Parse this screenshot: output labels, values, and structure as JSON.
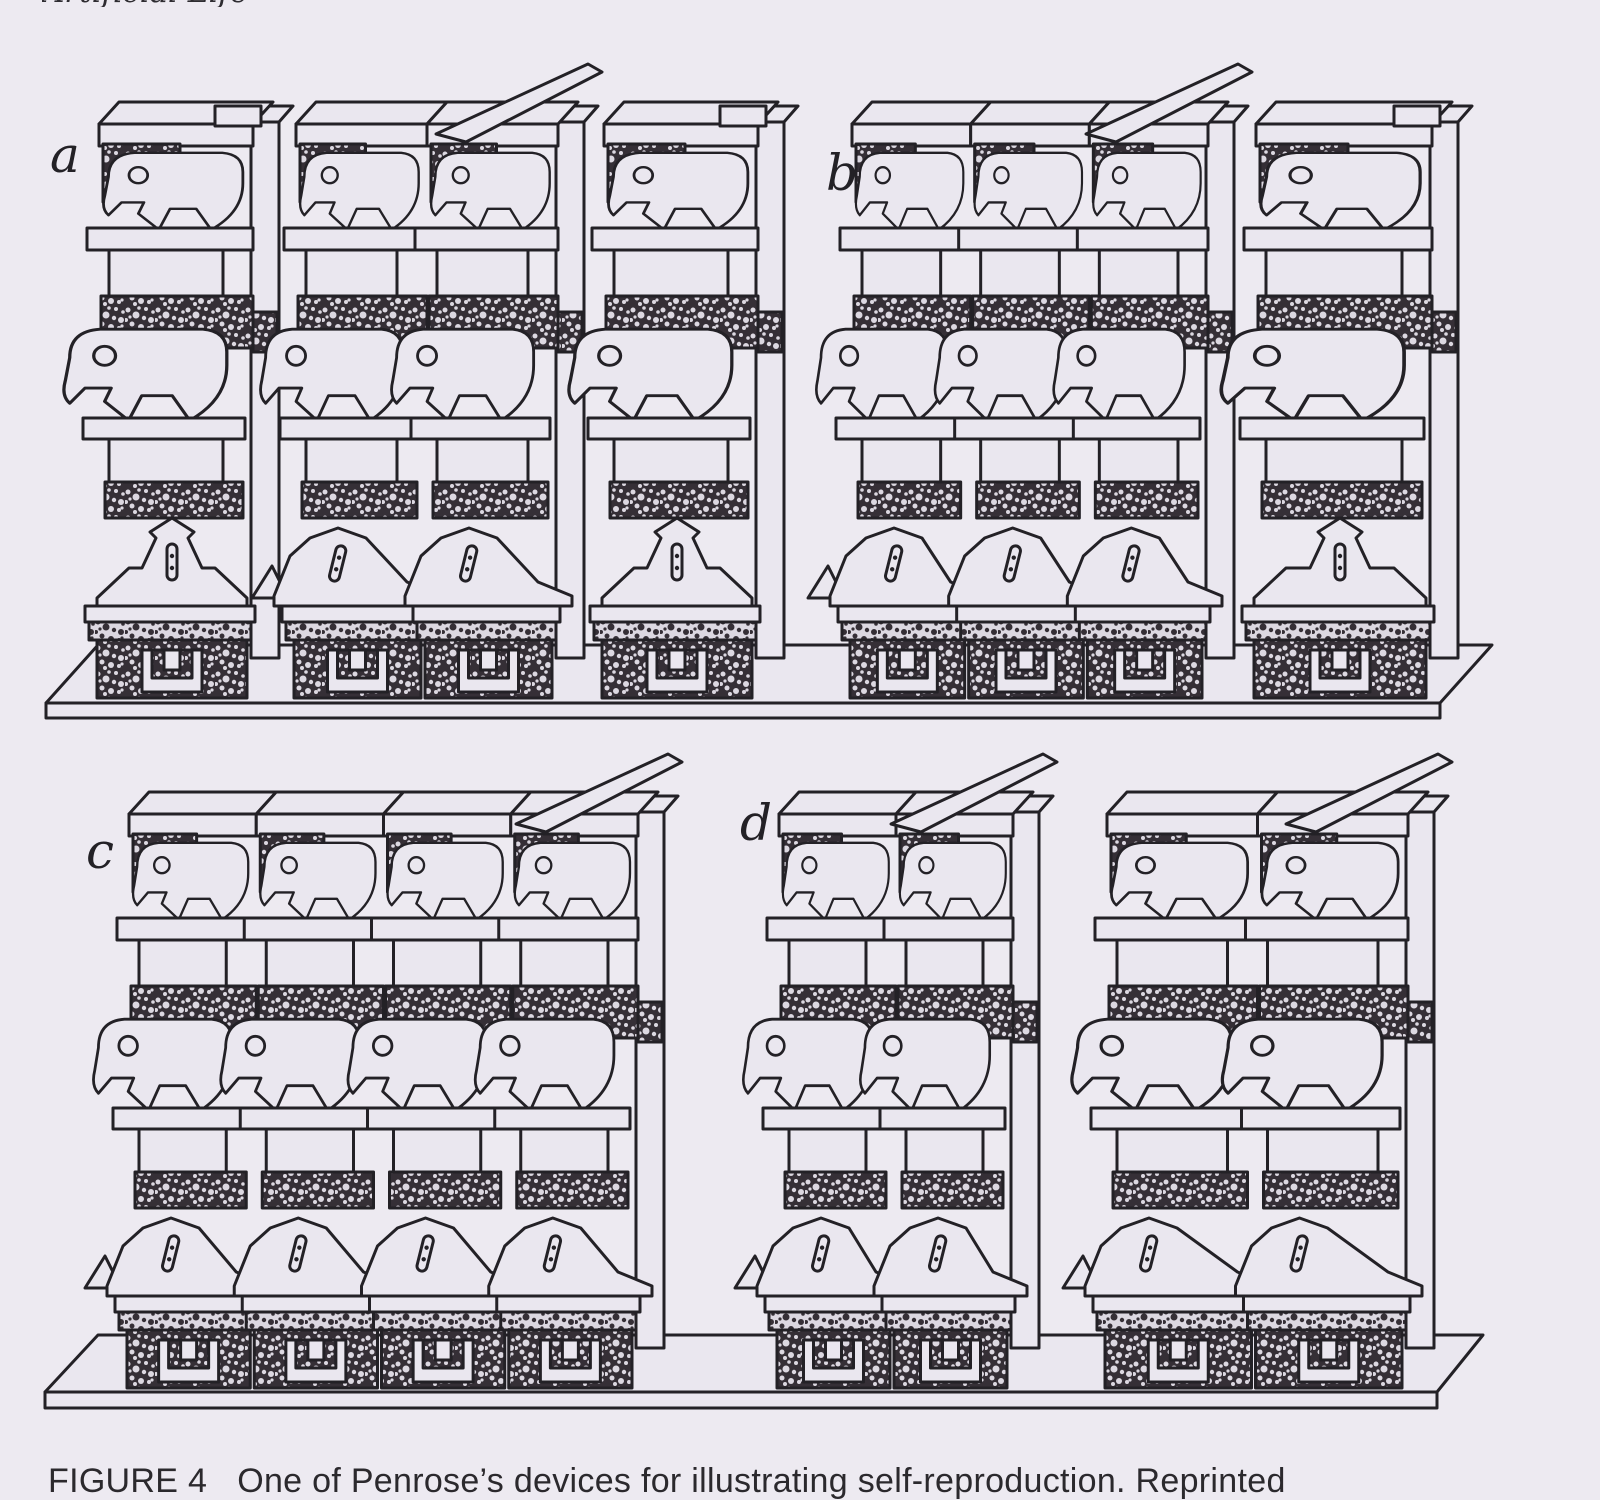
{
  "page": {
    "background": "#edeaf1",
    "ink": "#232126",
    "light_face": "#eae7ef",
    "stipple_dark": "#352f36",
    "stipple_light": "#dcd8e1"
  },
  "header": {
    "running_head": "Artificial Life",
    "page_number": "77"
  },
  "caption": {
    "label": "FIGURE 4",
    "text": "One of Penrose’s devices for illustrating self-reproduction. Reprinted"
  },
  "figure": {
    "description": "Four stages (a–d) of Penrose self-reproducing hook-block machines standing on planks",
    "rows": [
      {
        "name": "top",
        "shelf": {
          "back": [
            98,
            645,
            1492
          ],
          "front": [
            46,
            703,
            1440
          ],
          "face_h": 15
        },
        "baseline_y": 658,
        "panels": [
          {
            "label": "a",
            "label_x": 50,
            "label_y": 172,
            "assemblies": [
              {
                "x": 95,
                "y": 98,
                "w": 190,
                "cols": 1,
                "linked": false
              },
              {
                "x": 292,
                "y": 98,
                "w": 298,
                "cols": 2,
                "linked": true
              },
              {
                "x": 600,
                "y": 98,
                "w": 190,
                "cols": 1,
                "linked": false
              }
            ]
          },
          {
            "label": "b",
            "label_x": 826,
            "label_y": 190,
            "assemblies": [
              {
                "x": 848,
                "y": 98,
                "w": 392,
                "cols": 3,
                "linked": true
              },
              {
                "x": 1252,
                "y": 98,
                "w": 212,
                "cols": 1,
                "linked": false
              }
            ]
          }
        ]
      },
      {
        "name": "bottom",
        "shelf": {
          "back": [
            98,
            1335,
            1483
          ],
          "front": [
            45,
            1392,
            1437
          ],
          "face_h": 16
        },
        "baseline_y": 1348,
        "panels": [
          {
            "label": "c",
            "label_x": 86,
            "label_y": 868,
            "assemblies": [
              {
                "x": 125,
                "y": 788,
                "w": 545,
                "cols": 4,
                "linked": true
              }
            ]
          },
          {
            "label": "d",
            "label_x": 740,
            "label_y": 840,
            "assemblies": [
              {
                "x": 775,
                "y": 788,
                "w": 270,
                "cols": 2,
                "linked": true
              },
              {
                "x": 1103,
                "y": 788,
                "w": 337,
                "cols": 2,
                "linked": true
              }
            ]
          }
        ]
      }
    ]
  }
}
